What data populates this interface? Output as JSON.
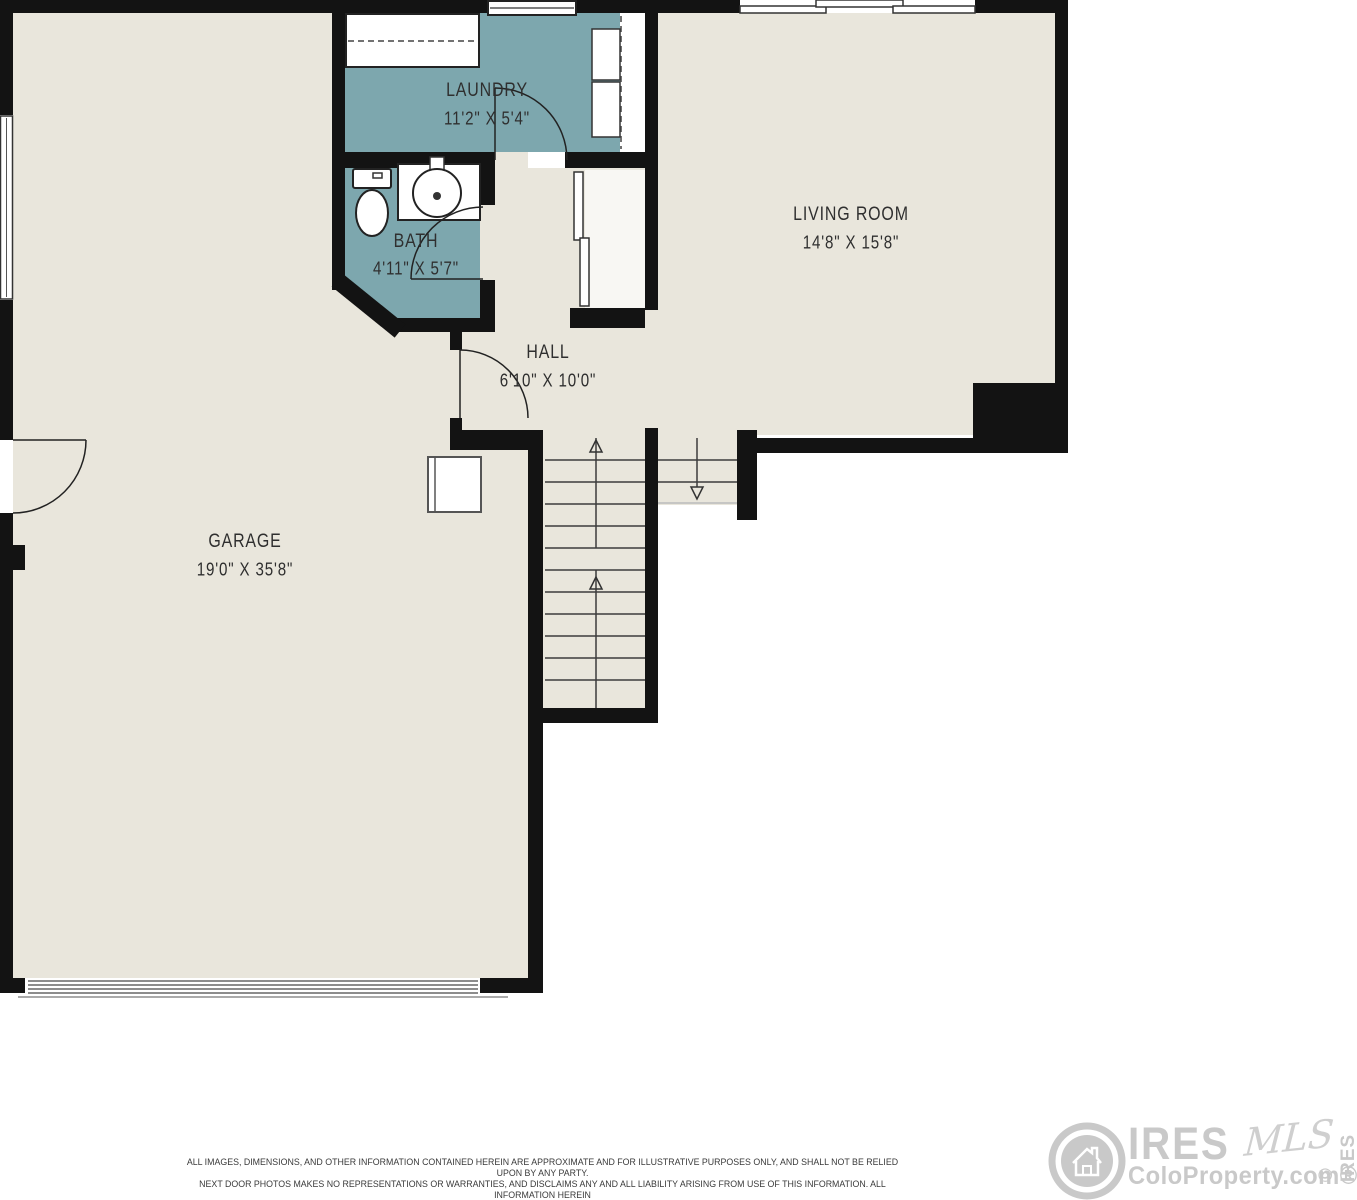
{
  "floorplan": {
    "rooms": [
      {
        "id": "laundry",
        "name": "LAUNDRY",
        "dims": "11'2\" X 5'4\""
      },
      {
        "id": "bath",
        "name": "BATH",
        "dims": "4'11\" X 5'7\""
      },
      {
        "id": "hall",
        "name": "HALL",
        "dims": "6'10\" X 10'0\""
      },
      {
        "id": "living-room",
        "name": "LIVING ROOM",
        "dims": "14'8\" X 15'8\""
      },
      {
        "id": "garage",
        "name": "GARAGE",
        "dims": "19'0\" X 35'8\""
      }
    ],
    "colors": {
      "floor": "#e9e6dc",
      "wet_room": "#7da7ae",
      "wall": "#131313",
      "label_text": "#2f2f2f"
    }
  },
  "disclaimer": {
    "line1": "ALL IMAGES, DIMENSIONS, AND OTHER INFORMATION CONTAINED HEREIN ARE APPROXIMATE AND FOR ILLUSTRATIVE PURPOSES ONLY, AND SHALL NOT BE RELIED UPON BY ANY PARTY.",
    "line2": "NEXT DOOR PHOTOS MAKES NO REPRESENTATIONS OR WARRANTIES, AND DISCLAIMS ANY AND ALL LIABILITY ARISING FROM USE OF THIS INFORMATION. ALL INFORMATION HEREIN",
    "line3": "SHALL BE SUBJECT TO THE TERMS AND CONDITIONS FOUND AT NEXTDOORPHOTOS.COM/TC."
  },
  "logo": {
    "brand": "IRES",
    "script": "MLS",
    "site": "ColoProperty.com®",
    "copyright": "© IRES"
  }
}
